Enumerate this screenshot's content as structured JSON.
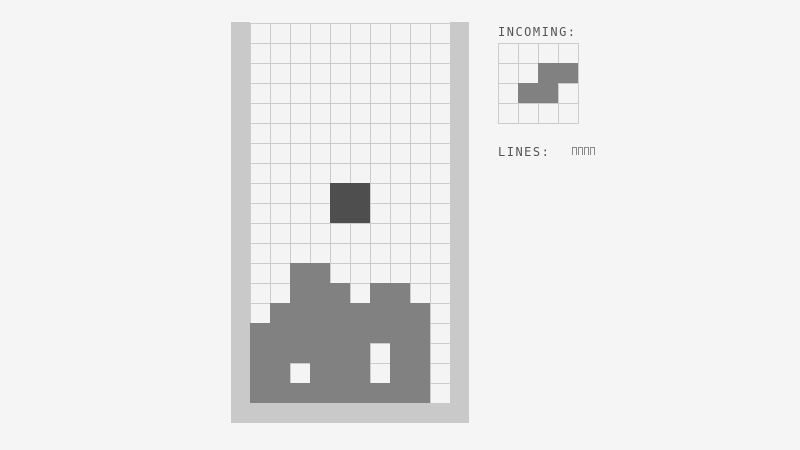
{
  "game": {
    "board": {
      "cols": 10,
      "rows": 19,
      "cell_px": 20,
      "legend": {
        "#": "stack-block",
        "@": "falling-piece",
        ".": "empty"
      },
      "grid_rows": [
        "..........",
        "..........",
        "..........",
        "..........",
        "..........",
        "..........",
        "..........",
        "..........",
        "....@@....",
        "....@@....",
        "..........",
        "..........",
        "..##......",
        "..###.##..",
        ".########.",
        "#########.",
        "######.##.",
        "##.###.##.",
        "#########."
      ]
    },
    "incoming": {
      "label": "INCOMING:",
      "cols": 4,
      "rows": 4,
      "grid_rows": [
        "....",
        "..##",
        ".##.",
        "...."
      ]
    },
    "lines": {
      "label": "LINES:",
      "value_box_count": 4
    },
    "colors": {
      "background": "#f5f5f5",
      "wall": "#c9c9c9",
      "grid_line": "#cccccc",
      "empty_cell": "#f4f4f4",
      "stack_block": "#818181",
      "falling_piece": "#4e4e4e",
      "label_text": "#555555",
      "counter_box": "#8a8a8a"
    }
  }
}
